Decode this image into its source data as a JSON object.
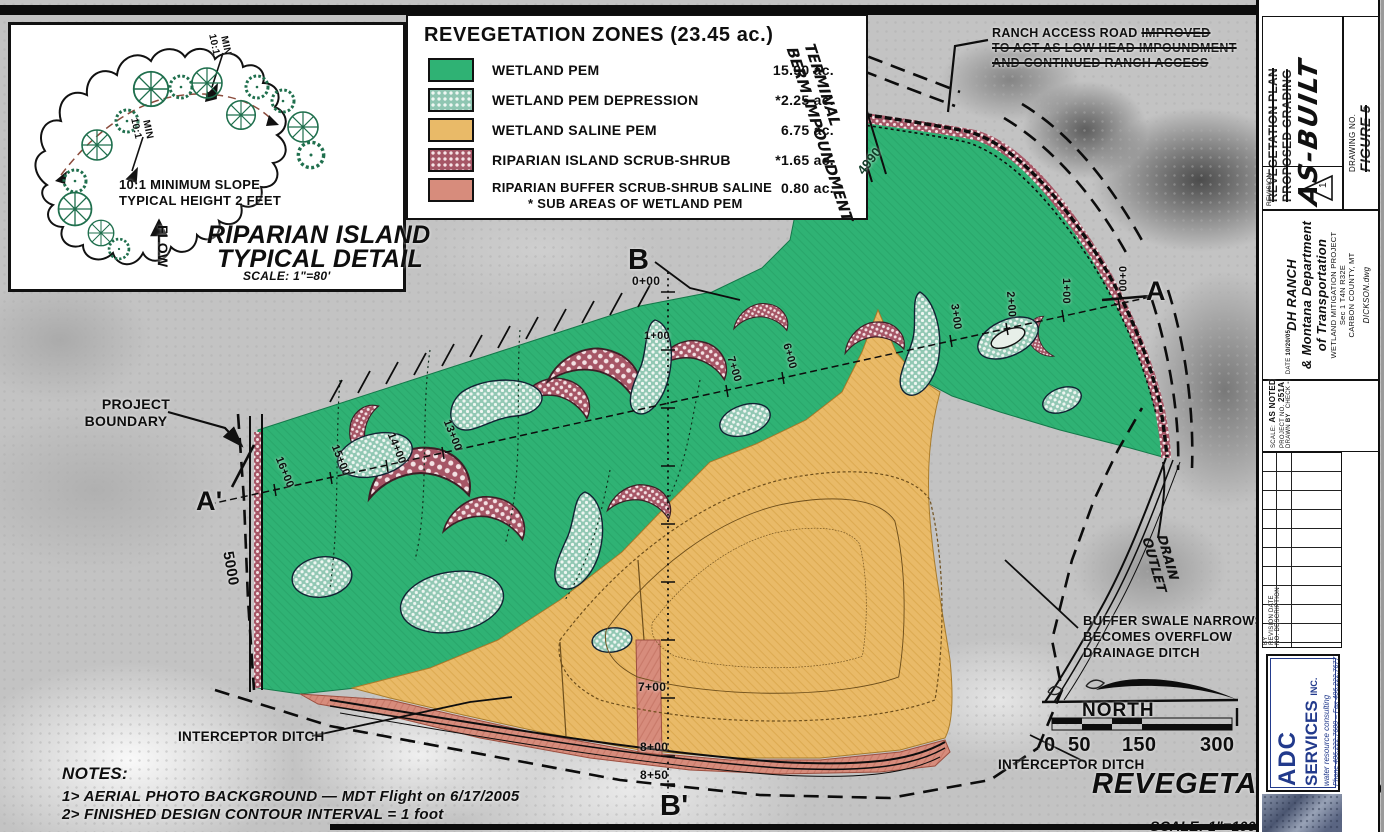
{
  "inset": {
    "slope_note": [
      "10:1 MINIMUM SLOPE",
      "TYPICAL HEIGHT 2 FEET"
    ],
    "slope_tag": "10:1",
    "slope_tag_min": "MIN",
    "flow": "FLOW",
    "title": [
      "RIPARIAN ISLAND",
      "TYPICAL DETAIL"
    ],
    "scale": "SCALE: 1\"=80'"
  },
  "legend": {
    "title": "REVEGETATION ZONES (23.45 ac.)",
    "items": [
      {
        "label": "WETLAND PEM",
        "acreage": "15.90 ac.",
        "color": "#2fb274",
        "pattern": "solid"
      },
      {
        "label": "WETLAND PEM DEPRESSION",
        "acreage": "*2.25 ac.",
        "color": "#8fc6b2",
        "pattern": "dots"
      },
      {
        "label": "WETLAND SALINE PEM",
        "acreage": "6.75 ac.",
        "color": "#e9ba68",
        "pattern": "solid"
      },
      {
        "label": "RIPARIAN ISLAND SCRUB-SHRUB",
        "acreage": "*1.65 ac.",
        "color": "#a65666",
        "pattern": "dots"
      },
      {
        "label": "RIPARIAN BUFFER SCRUB-SHRUB SALINE",
        "acreage": "0.80 ac.",
        "color": "#d78c7c",
        "pattern": "solid"
      }
    ],
    "footnote": "* SUB AREAS OF WETLAND PEM"
  },
  "callouts": {
    "ranch_access": {
      "line1": "RANCH ACCESS ROAD",
      "strike1": "IMPROVED",
      "line2": "TO ACT AS LOW HEAD IMPOUNDMENT",
      "line3": "AND CONTINUED RANCH ACCESS"
    },
    "terminal_berm": [
      "TERMINAL",
      "BERM IMPOUNDMENT"
    ],
    "project_boundary": [
      "PROJECT",
      "BOUNDARY"
    ],
    "interceptor_left": "INTERCEPTOR DITCH",
    "interceptor_right": "INTERCEPTOR DITCH",
    "buffer_swale": [
      "BUFFER SWALE NARROWS",
      "BECOMES OVERFLOW",
      "DRAINAGE DITCH"
    ],
    "drain_outlet": [
      "DRAIN",
      "OUTLET"
    ]
  },
  "map": {
    "sections": {
      "a": "A",
      "a_prime": "A'",
      "b": "B",
      "b_prime": "B'"
    },
    "stations_a": [
      "0+00",
      "1+00",
      "2+00",
      "3+00",
      "6+00",
      "7+00",
      "13+00",
      "14+00",
      "15+00",
      "16+00"
    ],
    "stations_b": [
      "0+00",
      "1+00",
      "7+00",
      "8+00",
      "8+50"
    ],
    "contours": {
      "berm": "4990",
      "left": "5000"
    }
  },
  "north_label": "NORTH",
  "scalebar": {
    "t0": "0",
    "t50": "50",
    "t150": "150",
    "t300": "300"
  },
  "plan_title": {
    "text": "REVEGETATION PLAN",
    "scale": "SCALE: 1\"=100'"
  },
  "notes": {
    "heading": "NOTES:",
    "n1": "1>  AERIAL PHOTO BACKGROUND — MDT Flight on 6/17/2005",
    "n2": "2> FINISHED DESIGN CONTOUR INTERVAL = 1 foot"
  },
  "titleblock": {
    "struck_titles": [
      "REVEGETATION PLAN",
      "PROPOSED GRADING"
    ],
    "asbuilt": "AS-BUILT",
    "drawing_no_label": "DRAWING NO.",
    "figure_no": "FIGURE 5",
    "revision_label": "REVISION",
    "revision_mark": "1",
    "client": [
      "DH RANCH",
      "& Montana Department",
      "of Transportation"
    ],
    "project": [
      "WETLAND MITIGATION PROJECT",
      "Sec 1 T4N R32E",
      "CARBON COUNTY, MT"
    ],
    "file_name": "DICKSON.dwg",
    "fields": {
      "scale_label": "SCALE:",
      "scale": "AS NOTED",
      "project_no_label": "PROJECT NO.",
      "project_no": "251A",
      "drawn_label": "DRAWN",
      "drawn": "BY",
      "check_label": "CHECK",
      "check": "--",
      "date_label": "DATE",
      "date": "10/20/05"
    },
    "rev_headers": [
      "BY",
      "REVISION DATE",
      "NO. DESCRIPTION"
    ],
    "firm": {
      "name1": "ADC",
      "name2": "SERVICES",
      "inc": "INC.",
      "tagline": "water resource consulting",
      "contact": "Phone 406.222.7600  –  Fax 406.222.7677",
      "color": "#223a8c"
    }
  },
  "colors": {
    "wetland_pem": "#2fb274",
    "pem_depression": "#8fc6b2",
    "saline_pem": "#e9ba68",
    "riparian_island": "#a65666",
    "riparian_buffer": "#d78c7c",
    "adc_blue": "#223a8c"
  }
}
